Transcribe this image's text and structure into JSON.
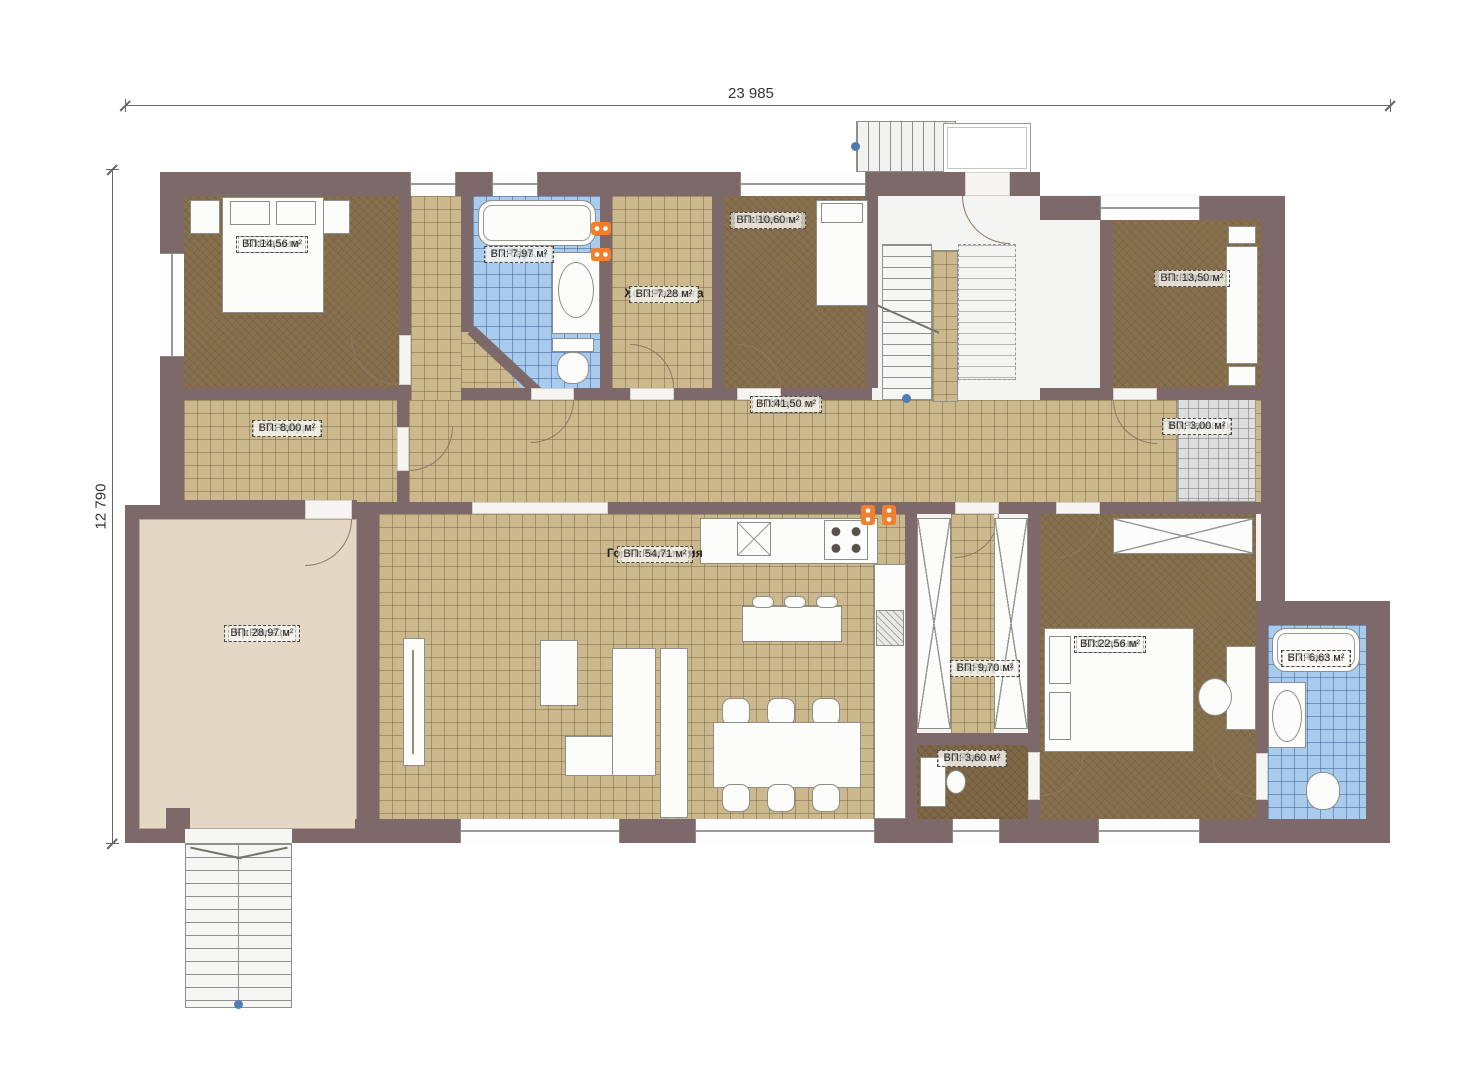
{
  "dimensions": {
    "width_label": "23 985",
    "height_label": "12 790"
  },
  "brand": "FixPlans.ru",
  "rooms": [
    {
      "name": "Спальня",
      "brand": "FixPlans.ru",
      "area": "ВП:14,56 м²"
    },
    {
      "name": "С/у",
      "brand": "FixPlans.ru",
      "area": "ВП: 7,97 м²"
    },
    {
      "name": "Хоз. комната",
      "brand": "FixPlans.ru",
      "area": "ВП: 7,28 м²"
    },
    {
      "name": "Спальня",
      "brand": "FixPlans.ru",
      "area": "ВП: 10,60 м²"
    },
    {
      "name": "Спальня",
      "brand": "FixPlans.ru",
      "area": "ВП: 13,50 м²"
    },
    {
      "name": "Тамбур",
      "brand": "FixPlans.ru",
      "area": "ВП: 8,00 м²"
    },
    {
      "name": "Холл",
      "brand": "FixPlans.ru",
      "area": "ВП:41,50 м²"
    },
    {
      "name": "Подъемник",
      "brand": "FixPlans.ru",
      "area": "ВП: 3,00 м²"
    },
    {
      "name": "Крыльцо",
      "brand": "FixPlans.ru",
      "area": "ВП: 28,97 м²"
    },
    {
      "name": "Гостиная-кухня",
      "brand": "FixPlans.ru",
      "area": "ВП: 54,71 м²"
    },
    {
      "name": "Гардероб",
      "brand": "FixPlans.ru",
      "area": "ВП: 9,70 м²"
    },
    {
      "name": "Спальня",
      "brand": "FixPlans.ru",
      "area": "ВП:22,56 м²"
    },
    {
      "name": "Кабинет",
      "brand": "FixPlans.ru",
      "area": "ВП: 3,60 м²"
    },
    {
      "name": "С/у",
      "brand": "FixPlans.ru",
      "area": "ВП: 6,63 м²"
    }
  ],
  "colors": {
    "wall": "#7d686a",
    "floor_tile": "#cbb88c",
    "floor_wood": "#87704e",
    "floor_bath": "#a9cbee",
    "floor_lift": "#dedede",
    "floor_porch": "#e4d7c6",
    "radiator": "#f07f2e",
    "ref_point": "#4d7db3"
  }
}
